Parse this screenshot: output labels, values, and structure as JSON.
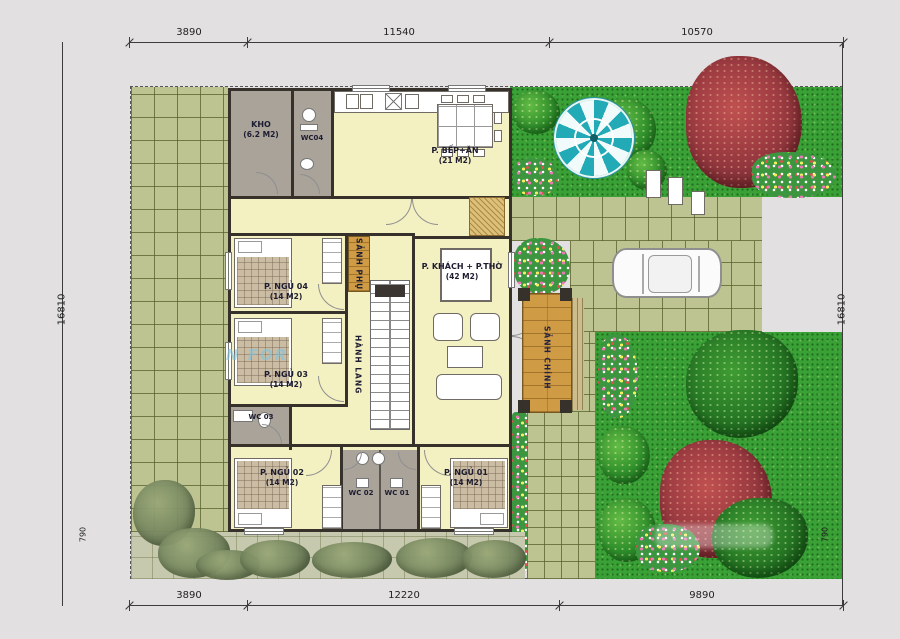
{
  "dims": {
    "top": [
      "3890",
      "11540",
      "10570"
    ],
    "bottom": [
      "3890",
      "12220",
      "9890"
    ],
    "left": {
      "total": "16810",
      "sub": "790"
    },
    "right": {
      "total": "16810",
      "sub": "790"
    }
  },
  "rooms": {
    "kho": {
      "name": "KHO",
      "area": "(6.2 M2)"
    },
    "wc04": {
      "name": "WC04"
    },
    "kitchen": {
      "name": "P. BẾP+ĂN",
      "area": "(21 M2)"
    },
    "bed04": {
      "name": "P. NGỦ 04",
      "area": "(14 M2)"
    },
    "bed03": {
      "name": "P. NGỦ 03",
      "area": "(14 M2)"
    },
    "bed02": {
      "name": "P. NGỦ 02",
      "area": "(14 M2)"
    },
    "bed01": {
      "name": "P. NGỦ 01",
      "area": "(14 M2)"
    },
    "living": {
      "name": "P. KHÁCH + P.THỜ",
      "area": "(42 M2)"
    },
    "wc03": {
      "name": "WC 03"
    },
    "wc02": {
      "name": "WC 02"
    },
    "wc01": {
      "name": "WC 01"
    },
    "sanh_phu": {
      "name": "SẢNH PHỤ"
    },
    "hanh_lang": {
      "name": "HÀNH LANG"
    },
    "sanh_chinh": {
      "name": "SẢNH CHÍNH"
    }
  },
  "watermark": "N FOR",
  "colors": {
    "floor": "#f3f0c2",
    "service_room": "#a9a39a",
    "wall": "#36312b",
    "tile": "#bec392",
    "grass": "#3aa136",
    "porch": "#cf9b45",
    "umbrella": "#22aab6"
  }
}
